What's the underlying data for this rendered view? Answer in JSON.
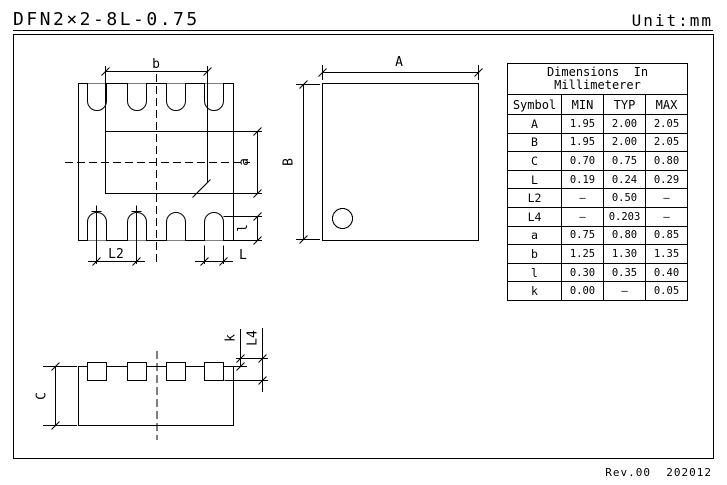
{
  "header": {
    "title": "DFN2×2-8L-0.75",
    "unit_label": "Unit:mm"
  },
  "footer": {
    "revision": "Rev.00  202012"
  },
  "dimension_table": {
    "title_line1": "Dimensions  In",
    "title_line2": "Millimeterer",
    "columns": [
      "Symbol",
      "MIN",
      "TYP",
      "MAX"
    ],
    "rows": [
      [
        "A",
        "1.95",
        "2.00",
        "2.05"
      ],
      [
        "B",
        "1.95",
        "2.00",
        "2.05"
      ],
      [
        "C",
        "0.70",
        "0.75",
        "0.80"
      ],
      [
        "L",
        "0.19",
        "0.24",
        "0.29"
      ],
      [
        "L2",
        "–",
        "0.50",
        "–"
      ],
      [
        "L4",
        "–",
        "0.203",
        "–"
      ],
      [
        "a",
        "0.75",
        "0.80",
        "0.85"
      ],
      [
        "b",
        "1.25",
        "1.30",
        "1.35"
      ],
      [
        "l",
        "0.30",
        "0.35",
        "0.40"
      ],
      [
        "k",
        "0.00",
        "–",
        "0.05"
      ]
    ]
  },
  "drawings": {
    "pad_view_labels": {
      "b": "b",
      "a": "a",
      "l": "l",
      "L2": "L2",
      "L": "L"
    },
    "outline_labels": {
      "A": "A",
      "B": "B"
    },
    "side_view_labels": {
      "C": "C",
      "k": "k",
      "L4": "L4"
    }
  },
  "colors": {
    "line": "#000000",
    "background": "#ffffff"
  }
}
